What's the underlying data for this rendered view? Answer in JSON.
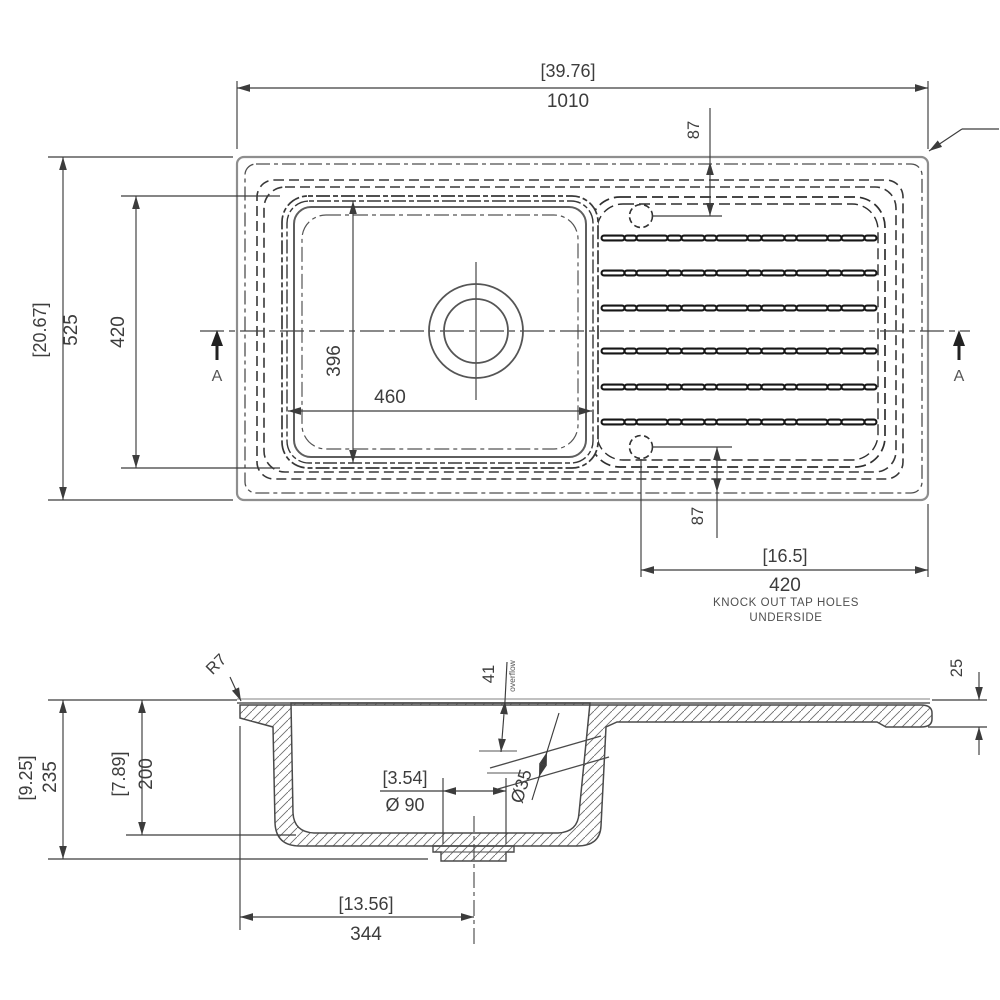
{
  "plan": {
    "overall_width_in": "[39.76]",
    "overall_width_mm": "1010",
    "overall_depth_in": "[20.67]",
    "overall_depth_mm": "525",
    "bowl_length": "420",
    "bowl_inner_length": "396",
    "bowl_inner_width": "460",
    "tap_hole_offset_top": "87",
    "tap_hole_offset_bottom": "87",
    "tap_span_in": "[16.5]",
    "tap_span_mm": "420",
    "tap_note_line1": "KNOCK OUT TAP HOLES",
    "tap_note_line2": "UNDERSIDE",
    "section_marker_left": "A",
    "section_marker_right": "A"
  },
  "section": {
    "overall_height_in": "[9.25]",
    "overall_height_mm": "235",
    "bowl_depth_in": "[7.89]",
    "bowl_depth_mm": "200",
    "corner_radius": "R7",
    "overflow_offset": "41",
    "overflow_label": "overflow",
    "overflow_dia": "Ø35",
    "waste_dia_in": "[3.54]",
    "waste_dia_mm": "Ø 90",
    "drainer_edge_thickness": "25",
    "waste_centre_in": "[13.56]",
    "waste_centre_mm": "344"
  }
}
